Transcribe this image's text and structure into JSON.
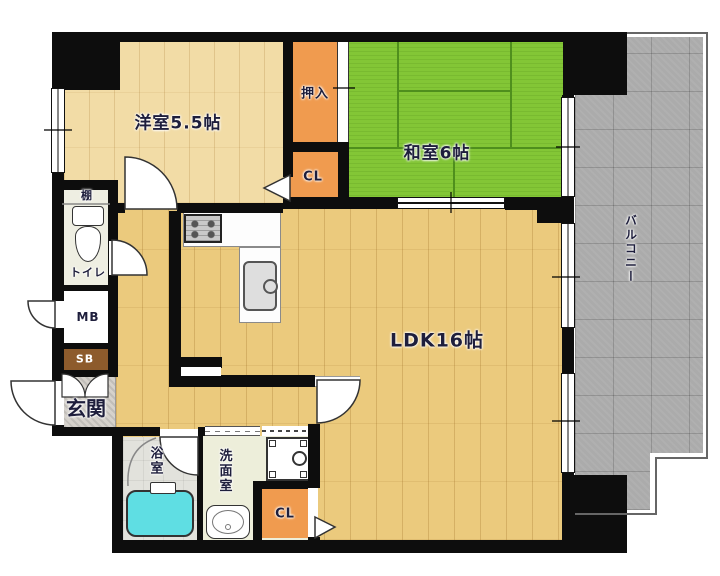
{
  "plan": {
    "rooms": {
      "western_room": {
        "label": "洋室5.5帖"
      },
      "japanese_room": {
        "label": "和室6帖"
      },
      "ldk": {
        "label": "LDK16帖"
      },
      "oshiire": {
        "label": "押入"
      },
      "closet_upper": {
        "label": "CL"
      },
      "closet_lower": {
        "label": "CL"
      },
      "balcony": {
        "label": "バルコニー"
      },
      "entrance": {
        "label": "玄関"
      },
      "toilet": {
        "label": "トイレ"
      },
      "shelf": {
        "label": "棚"
      },
      "meter_box": {
        "label": "MB"
      },
      "shaft_box": {
        "label": "SB"
      },
      "bathroom": {
        "label": "浴室"
      },
      "washroom": {
        "label": "洗面室"
      }
    },
    "colors": {
      "wall": "#0d0d0d",
      "wood_ldk": "#ebca7d",
      "wood_west": "#f2dca6",
      "tatami": "#83c636",
      "tatami_line": "#4f8f1d",
      "closet_orange": "#f09b4f",
      "balcony_gray": "#ababab",
      "entrance_tile": "#d6d2cc",
      "bath_tile": "#e2e2dc",
      "bathtub": "#5fdee3",
      "washroom_floor": "#edeeda",
      "toilet_floor": "#eeeee2",
      "shaft_brown": "#8d5b2c",
      "label_color": "#1e1e3c"
    }
  }
}
